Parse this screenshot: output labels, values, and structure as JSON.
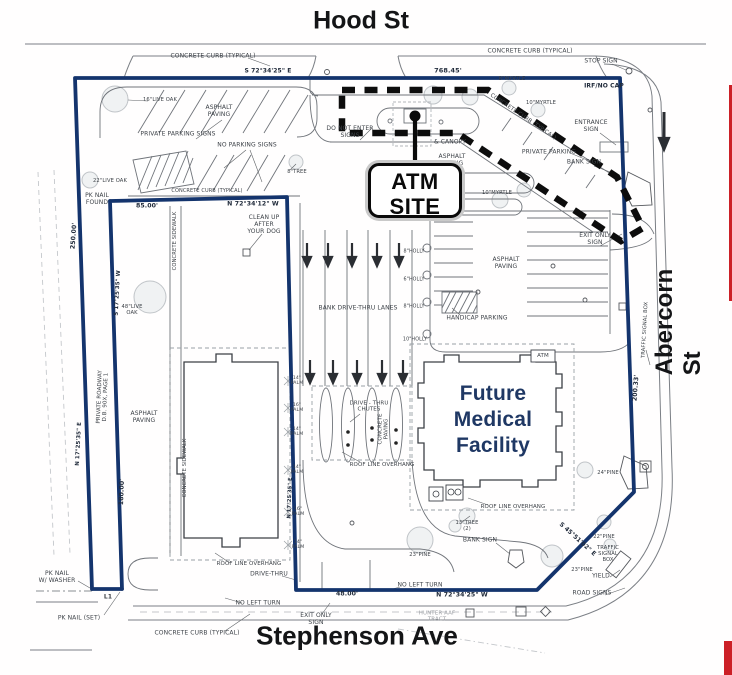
{
  "streets": {
    "hood": "Hood St",
    "abercorn": "Abercorn St",
    "stephenson": "Stephenson Ave"
  },
  "callout": {
    "line1": "ATM",
    "line2": "SITE"
  },
  "building": {
    "line1": "Future",
    "line2": "Medical",
    "line3": "Facility"
  },
  "colors": {
    "boundary": "#14346d",
    "dashed_outline": "#0d0d0d",
    "fmf_text": "#1f3864",
    "red_mark": "#cc2027"
  },
  "annotations": [
    {
      "name": "concrete-curb-typical-top",
      "text": "CONCRETE CURB (TYPICAL)",
      "x": 213,
      "y": 57,
      "fs": 6
    },
    {
      "name": "bearing-hood",
      "text": "S 72°34'25\" E",
      "x": 268,
      "y": 72,
      "fs": 6,
      "w": 700,
      "col": "#222c3c"
    },
    {
      "name": "distance-hood",
      "text": "768.45'",
      "x": 448,
      "y": 71,
      "fs": 6.5,
      "w": 700,
      "col": "#222c3c"
    },
    {
      "name": "stop-sign-label",
      "text": "STOP SIGN",
      "x": 601,
      "y": 62,
      "fs": 6
    },
    {
      "name": "irf-no-cap-label",
      "text": "IRF/NO CAP",
      "x": 604,
      "y": 87,
      "fs": 6,
      "w": 700,
      "col": "#222c3c"
    },
    {
      "name": "concrete-curb-typical-ne",
      "text": "CONCRETE CURB (TYPICAL)",
      "x": 530,
      "y": 52,
      "fs": 6
    },
    {
      "name": "myrtle-8",
      "text": "8\"MYRTLE",
      "x": 512,
      "y": 80,
      "fs": 5.2
    },
    {
      "name": "myrtle-10a",
      "text": "10\"MYRTLE",
      "x": 541,
      "y": 104,
      "fs": 5.2
    },
    {
      "name": "concrete-curb-diagonal",
      "text": "CONCRETE CURB (TYPICAL)",
      "x": 523,
      "y": 117,
      "fs": 5.5,
      "rot": 34
    },
    {
      "name": "entrance-sign-label",
      "text": "ENTRANCE\nSIGN",
      "x": 591,
      "y": 127,
      "fs": 6
    },
    {
      "name": "private-parking-label",
      "text": "PRIVATE PARKING",
      "x": 549,
      "y": 153,
      "fs": 6
    },
    {
      "name": "bank-sign-ne",
      "text": "BANK SIGN",
      "x": 584,
      "y": 163,
      "fs": 6
    },
    {
      "name": "do-not-enter-signs",
      "text": "DO NOT ENTER\nSIGNS",
      "x": 350,
      "y": 133,
      "fs": 6
    },
    {
      "name": "canopy-label",
      "text": "& CANOPY",
      "x": 450,
      "y": 143,
      "fs": 6
    },
    {
      "name": "asphalt-paving-atm",
      "text": "ASPHALT\nPAVING",
      "x": 452,
      "y": 161,
      "fs": 6
    },
    {
      "name": "myrtle-10b",
      "text": "10\"MYRTLE",
      "x": 497,
      "y": 194,
      "fs": 5.2
    },
    {
      "name": "live-oak-16",
      "text": "16\"LIVE OAK",
      "x": 160,
      "y": 101,
      "fs": 5.2
    },
    {
      "name": "private-parking-signs",
      "text": "PRIVATE PARKING SIGNS",
      "x": 178,
      "y": 135,
      "fs": 6
    },
    {
      "name": "no-parking-signs",
      "text": "NO PARKING SIGNS",
      "x": 247,
      "y": 146,
      "fs": 6
    },
    {
      "name": "asphalt-paving-nw",
      "text": "ASPHALT\nPAVING",
      "x": 219,
      "y": 112,
      "fs": 6
    },
    {
      "name": "tree-8",
      "text": "8\"TREE",
      "x": 297,
      "y": 173,
      "fs": 5.2
    },
    {
      "name": "live-oak-22",
      "text": "22\"LIVE OAK",
      "x": 110,
      "y": 182,
      "fs": 5.2
    },
    {
      "name": "pk-nail-found",
      "text": "PK NAIL\nFOUND",
      "x": 97,
      "y": 200,
      "fs": 6
    },
    {
      "name": "distance-85",
      "text": "85.00'",
      "x": 147,
      "y": 206,
      "fs": 6.2,
      "w": 700,
      "col": "#222c3c"
    },
    {
      "name": "bearing-inner-top",
      "text": "N 72°34'12\" W",
      "x": 253,
      "y": 204,
      "fs": 6.2,
      "w": 700,
      "col": "#222c3c"
    },
    {
      "name": "concrete-curb-inner",
      "text": "CONCRETE CURB (TYPICAL)",
      "x": 207,
      "y": 192,
      "fs": 5
    },
    {
      "name": "clean-up-after-dog",
      "text": "CLEAN UP\nAFTER\nYOUR DOG",
      "x": 264,
      "y": 225,
      "fs": 6
    },
    {
      "name": "distance-250",
      "text": "250.00'",
      "x": 74,
      "y": 236,
      "fs": 6.2,
      "rot": -86,
      "w": 700,
      "col": "#222c3c"
    },
    {
      "name": "bearing-outer-left",
      "text": "N 17°25'35\" E",
      "x": 79,
      "y": 444,
      "fs": 5.5,
      "rot": -87,
      "w": 700,
      "col": "#222c3c"
    },
    {
      "name": "private-roadway",
      "text": "PRIVATE ROADWAY\nD.B. 90X, PAGE 1",
      "x": 103,
      "y": 397,
      "fs": 5.5,
      "rot": -88
    },
    {
      "name": "bearing-inner-left",
      "text": "S 17°25'35\" W",
      "x": 118,
      "y": 293,
      "fs": 5.5,
      "rot": -87,
      "w": 700,
      "col": "#222c3c"
    },
    {
      "name": "distance-180",
      "text": "180.00'",
      "x": 122,
      "y": 492,
      "fs": 6.2,
      "rot": -88,
      "w": 700,
      "col": "#222c3c"
    },
    {
      "name": "concrete-sidewalk-w1",
      "text": "CONCRETE SIDEWALK",
      "x": 176,
      "y": 241,
      "fs": 5.2,
      "rot": -90
    },
    {
      "name": "concrete-sidewalk-w2",
      "text": "CONCRETE SIDEWALK",
      "x": 186,
      "y": 468,
      "fs": 5.2,
      "rot": -90
    },
    {
      "name": "asphalt-paving-w",
      "text": "ASPHALT\nPAVING",
      "x": 144,
      "y": 418,
      "fs": 6
    },
    {
      "name": "live-oak-48",
      "text": "48\"LIVE\nOAK",
      "x": 132,
      "y": 311,
      "fs": 5.2
    },
    {
      "name": "exit-only-sign-ne",
      "text": "EXIT ONLY\nSIGN",
      "x": 595,
      "y": 240,
      "fs": 6
    },
    {
      "name": "asphalt-paving-e",
      "text": "ASPHALT\nPAVING",
      "x": 506,
      "y": 264,
      "fs": 6
    },
    {
      "name": "handicap-parking",
      "text": "HANDICAP PARKING",
      "x": 477,
      "y": 319,
      "fs": 6
    },
    {
      "name": "holly-1",
      "text": "8\"HOLLY",
      "x": 414,
      "y": 252,
      "fs": 4.8
    },
    {
      "name": "holly-2",
      "text": "6\"HOLLY",
      "x": 414,
      "y": 280,
      "fs": 4.8
    },
    {
      "name": "holly-3",
      "text": "8\"HOLLY",
      "x": 414,
      "y": 307,
      "fs": 4.8
    },
    {
      "name": "holly-4",
      "text": "10\"HOLLY",
      "x": 415,
      "y": 340,
      "fs": 4.8
    },
    {
      "name": "bank-drive-thru-lanes",
      "text": "BANK DRIVE-THRU LANES",
      "x": 358,
      "y": 309,
      "fs": 6
    },
    {
      "name": "drive-thru-chutes",
      "text": "DRIVE - THRU\nCHUTES",
      "x": 369,
      "y": 407,
      "fs": 5.5
    },
    {
      "name": "concrete-paving",
      "text": "CONCRETE\nPAVING",
      "x": 384,
      "y": 429,
      "fs": 5.5,
      "rot": -90
    },
    {
      "name": "roof-line-overhang-chutes",
      "text": "ROOF LINE OVERHANG",
      "x": 382,
      "y": 465,
      "fs": 5.5
    },
    {
      "name": "atm-small-label",
      "text": "ATM",
      "x": 543,
      "y": 356,
      "fs": 5.5
    },
    {
      "name": "roof-line-overhang-fmf",
      "text": "ROOF LINE OVERHANG",
      "x": 513,
      "y": 507,
      "fs": 5.5
    },
    {
      "name": "distance-200",
      "text": "200.33'",
      "x": 636,
      "y": 388,
      "fs": 6.2,
      "rot": -86,
      "w": 700,
      "col": "#222c3c"
    },
    {
      "name": "traffic-signal-box-e",
      "text": "TRAFFIC SIGNAL BOX",
      "x": 646,
      "y": 330,
      "fs": 5.2,
      "rot": -87
    },
    {
      "name": "pine-24",
      "text": "24\"PINE",
      "x": 608,
      "y": 474,
      "fs": 5.2
    },
    {
      "name": "tree-13",
      "text": "13\"TREE\n(2)",
      "x": 467,
      "y": 527,
      "fs": 5.2
    },
    {
      "name": "pine-23a",
      "text": "23\"PINE",
      "x": 420,
      "y": 556,
      "fs": 5.2
    },
    {
      "name": "pine-23b",
      "text": "23\"PINE",
      "x": 582,
      "y": 571,
      "fs": 5.2
    },
    {
      "name": "pine-22",
      "text": "22\"PINE",
      "x": 604,
      "y": 538,
      "fs": 5.2
    },
    {
      "name": "traffic-signal-box-s",
      "text": "TRAFFIC\nSIGNAL\nBOX",
      "x": 608,
      "y": 555,
      "fs": 5.2
    },
    {
      "name": "yield-label",
      "text": "YIELD",
      "x": 601,
      "y": 577,
      "fs": 6
    },
    {
      "name": "road-signs-label",
      "text": "ROAD SIGNS",
      "x": 592,
      "y": 594,
      "fs": 6
    },
    {
      "name": "bank-sign-s",
      "text": "BANK SIGN",
      "x": 480,
      "y": 541,
      "fs": 6
    },
    {
      "name": "bearing-diagonal",
      "text": "S 45°51'02\" E",
      "x": 577,
      "y": 540,
      "fs": 6,
      "rot": 42,
      "w": 700,
      "col": "#222c3c"
    },
    {
      "name": "bearing-stephenson",
      "text": "N 72°34'25\" W",
      "x": 462,
      "y": 595,
      "fs": 6.2,
      "w": 700,
      "col": "#222c3c"
    },
    {
      "name": "distance-48",
      "text": "48.00'",
      "x": 347,
      "y": 594,
      "fs": 6.2,
      "w": 700,
      "col": "#222c3c"
    },
    {
      "name": "no-left-turn-1",
      "text": "NO LEFT TURN",
      "x": 420,
      "y": 586,
      "fs": 6
    },
    {
      "name": "no-left-turn-2",
      "text": "NO LEFT TURN",
      "x": 258,
      "y": 604,
      "fs": 6
    },
    {
      "name": "exit-only-sign-s",
      "text": "EXIT ONLY\nSIGN",
      "x": 316,
      "y": 620,
      "fs": 6
    },
    {
      "name": "drive-thru-label",
      "text": "DRIVE-THRU",
      "x": 269,
      "y": 575,
      "fs": 6
    },
    {
      "name": "roof-line-overhang-w",
      "text": "ROOF LINE OVERHANG",
      "x": 249,
      "y": 564,
      "fs": 5.5
    },
    {
      "name": "concrete-curb-typical-s",
      "text": "CONCRETE CURB (TYPICAL)",
      "x": 197,
      "y": 634,
      "fs": 6
    },
    {
      "name": "pk-nail-washer",
      "text": "PK NAIL\nW/ WASHER",
      "x": 57,
      "y": 578,
      "fs": 6
    },
    {
      "name": "l1-label",
      "text": "L1",
      "x": 108,
      "y": 598,
      "fs": 6,
      "w": 700
    },
    {
      "name": "pk-nail-set",
      "text": "PK NAIL (SET)",
      "x": 79,
      "y": 619,
      "fs": 6
    },
    {
      "name": "hunter-aaf-tract",
      "text": "HUNTER AAF\nTRACT",
      "x": 437,
      "y": 617,
      "fs": 5.5,
      "col": "#9b9ea3"
    },
    {
      "name": "bearing-inner-right",
      "text": "N 17°25'35\" E",
      "x": 291,
      "y": 498,
      "fs": 5.2,
      "rot": -88,
      "w": 700,
      "col": "#222c3c"
    },
    {
      "name": "palm-1",
      "text": "14\"\nPALM",
      "x": 297,
      "y": 381,
      "fs": 4.6
    },
    {
      "name": "palm-2",
      "text": "16\"\nPALM",
      "x": 297,
      "y": 408,
      "fs": 4.6
    },
    {
      "name": "palm-3",
      "text": "14\"\nPALM",
      "x": 297,
      "y": 432,
      "fs": 4.6
    },
    {
      "name": "palm-4",
      "text": "14\"\nPALM",
      "x": 297,
      "y": 470,
      "fs": 4.6
    },
    {
      "name": "palm-5",
      "text": "16\"\nPALM",
      "x": 298,
      "y": 512,
      "fs": 4.6
    },
    {
      "name": "palm-6",
      "text": "14\"\nPALM",
      "x": 298,
      "y": 545,
      "fs": 4.6
    }
  ]
}
